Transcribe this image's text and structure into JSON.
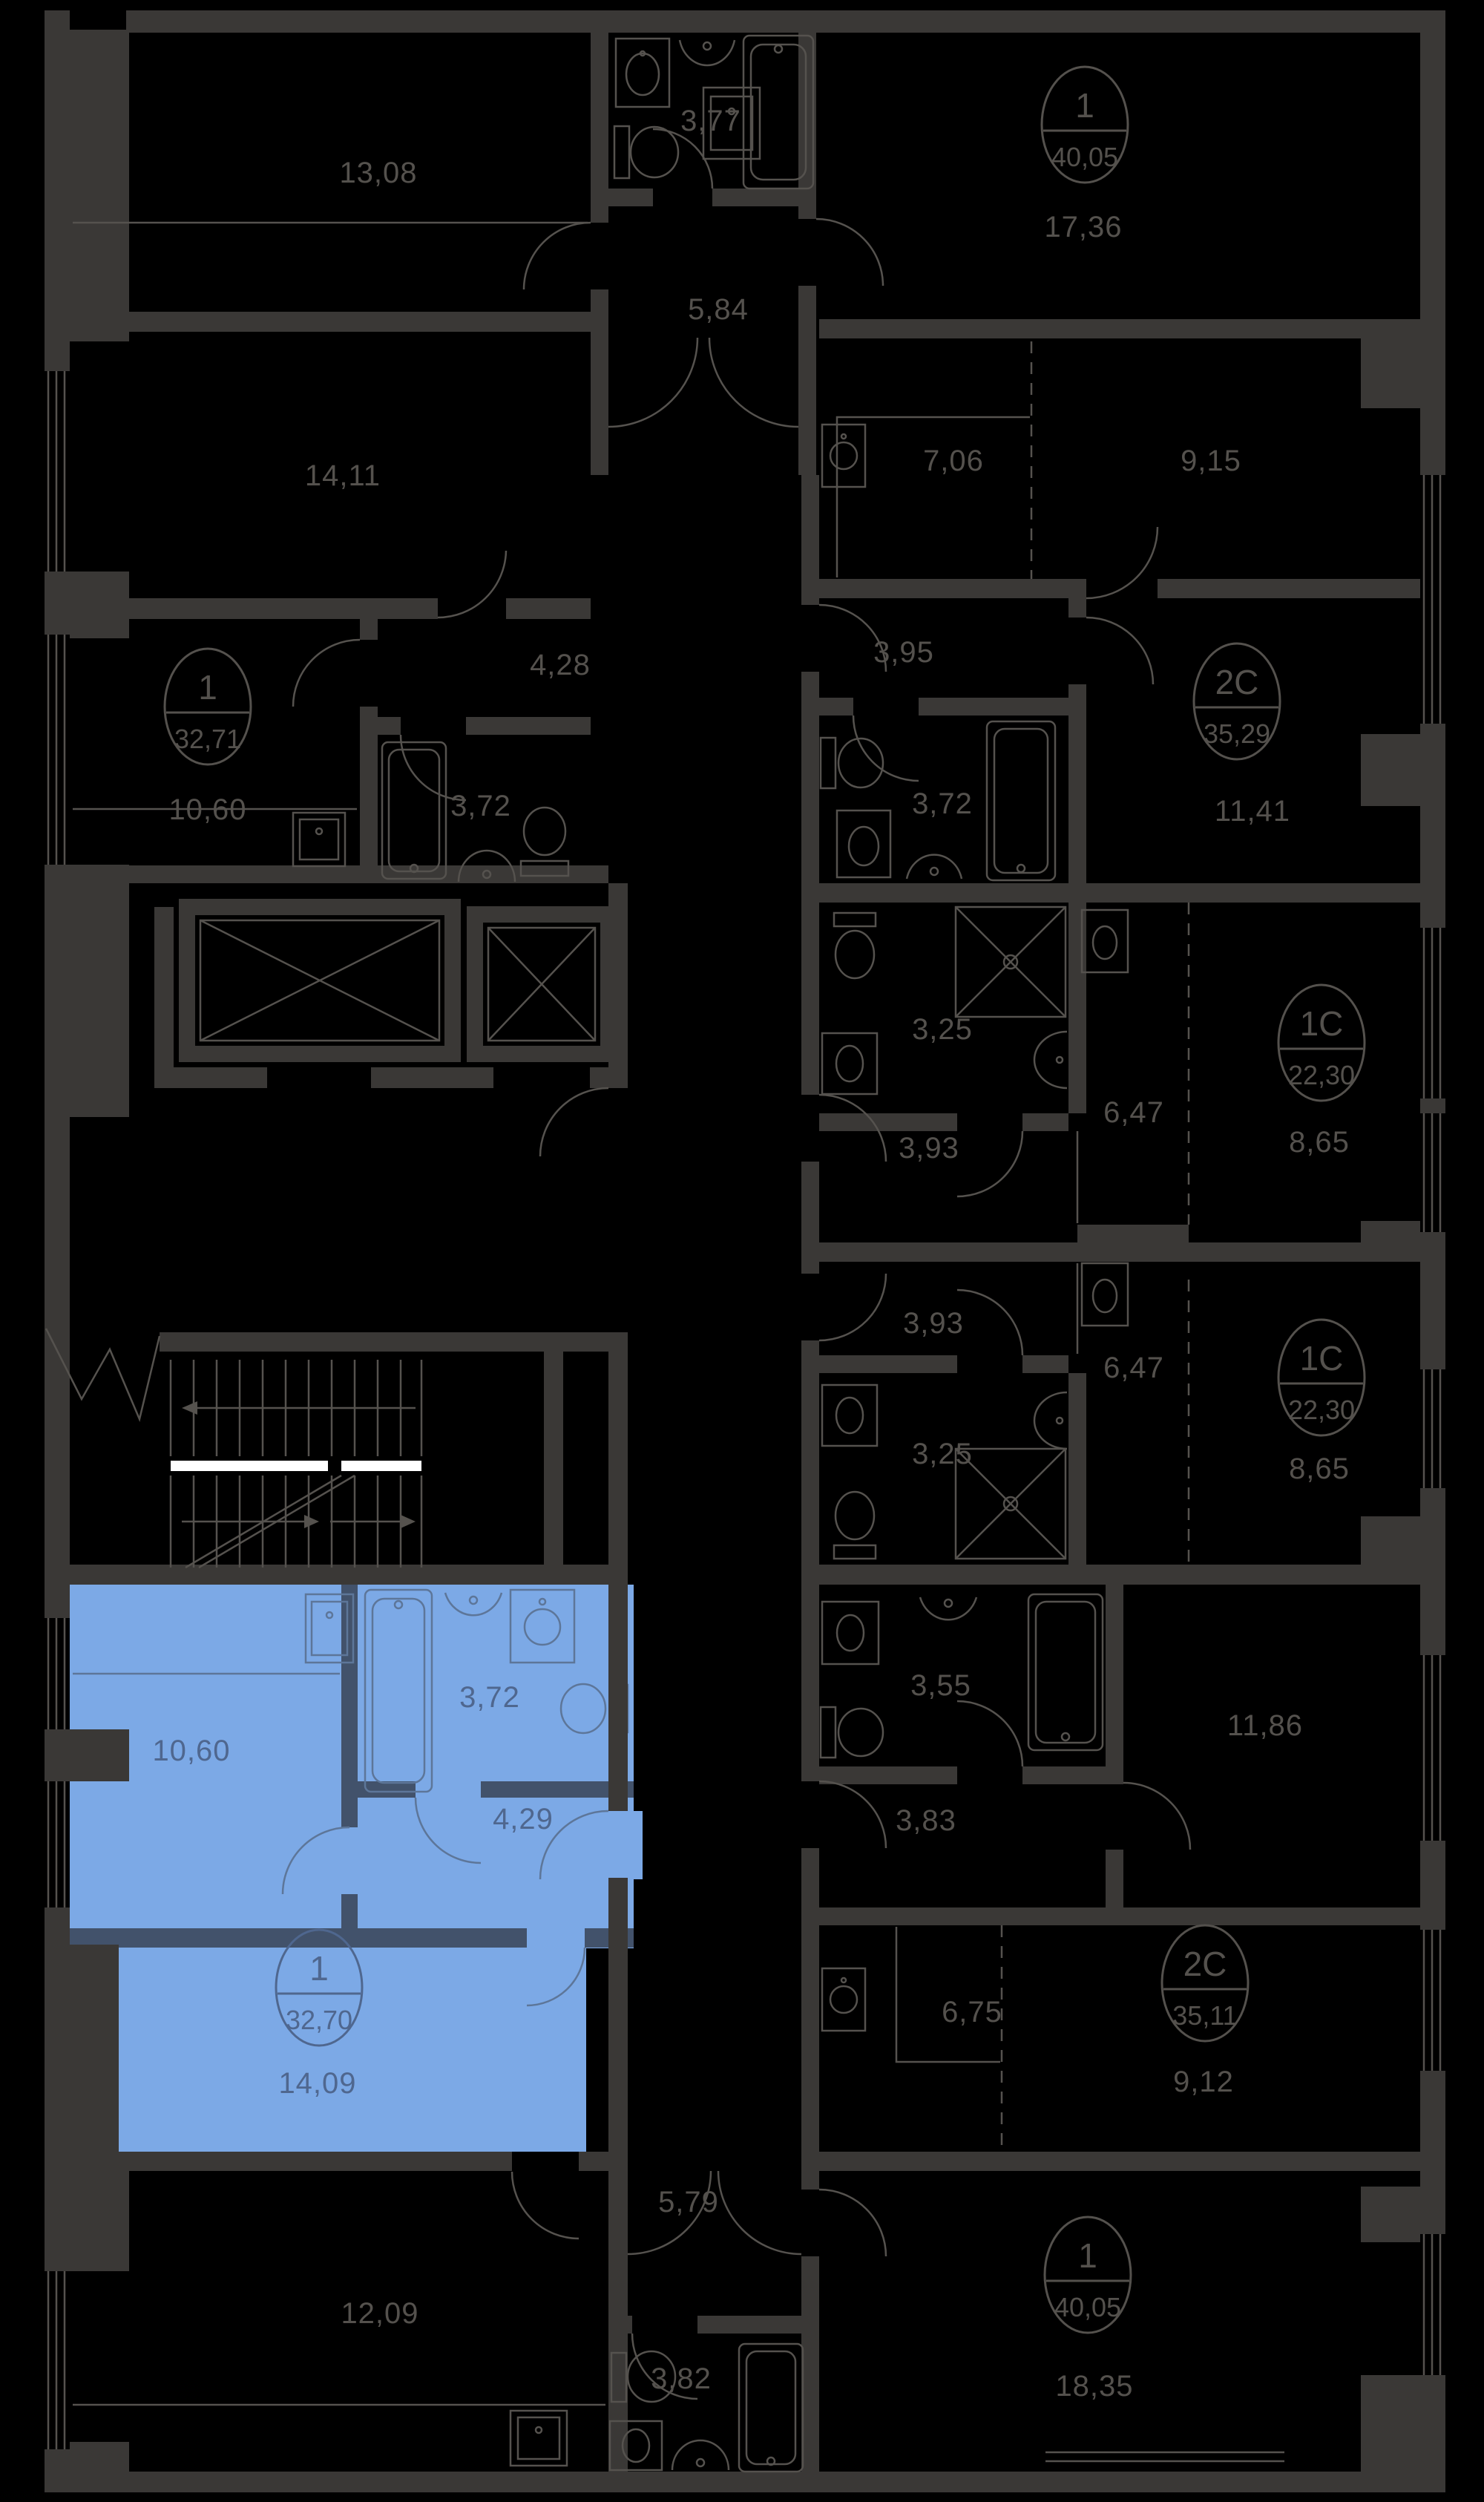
{
  "colors": {
    "background": "#000000",
    "walls": "#3a3836",
    "lines": "#55524e",
    "room_label": "#54514d",
    "selected_fill": "#7ca9e6",
    "selected_walls": "#42526b",
    "selected_lines": "#5d7699",
    "selected_label": "#4f678f",
    "stair_landing": "#ffffff"
  },
  "units": {
    "top_40_05": {
      "number": "1",
      "area": "40,05"
    },
    "left_32_71": {
      "number": "1",
      "area": "32,71"
    },
    "right_35_29": {
      "number": "2C",
      "area": "35,29"
    },
    "mid_22_30_a": {
      "number": "1C",
      "area": "22,30"
    },
    "mid_22_30_b": {
      "number": "1C",
      "area": "22,30"
    },
    "selected_32_70": {
      "number": "1",
      "area": "32,70"
    },
    "right_35_11": {
      "number": "2C",
      "area": "35,11"
    },
    "bottom_40_05": {
      "number": "1",
      "area": "40,05"
    }
  },
  "rooms": {
    "r13_08": "13,08",
    "r3_77": "3,77",
    "r5_84": "5,84",
    "r17_36": "17,36",
    "r14_11": "14,11",
    "r7_06": "7,06",
    "r9_15": "9,15",
    "r4_28": "4,28",
    "r3_95": "3,95",
    "r10_60": "10,60",
    "r3_72a": "3,72",
    "r3_72b": "3,72",
    "r11_41": "11,41",
    "r3_25a": "3,25",
    "r3_93a": "3,93",
    "r6_47a": "6,47",
    "r8_65a": "8,65",
    "r3_93b": "3,93",
    "r6_47b": "6,47",
    "r8_65b": "8,65",
    "r3_25b": "3,25",
    "sel_10_60": "10,60",
    "sel_3_72": "3,72",
    "sel_4_29": "4,29",
    "sel_14_09": "14,09",
    "r3_55": "3,55",
    "r11_86": "11,86",
    "r3_83": "3,83",
    "r6_75": "6,75",
    "r9_12": "9,12",
    "r5_79": "5,79",
    "r12_09": "12,09",
    "r3_82": "3,82",
    "r18_35": "18,35"
  }
}
